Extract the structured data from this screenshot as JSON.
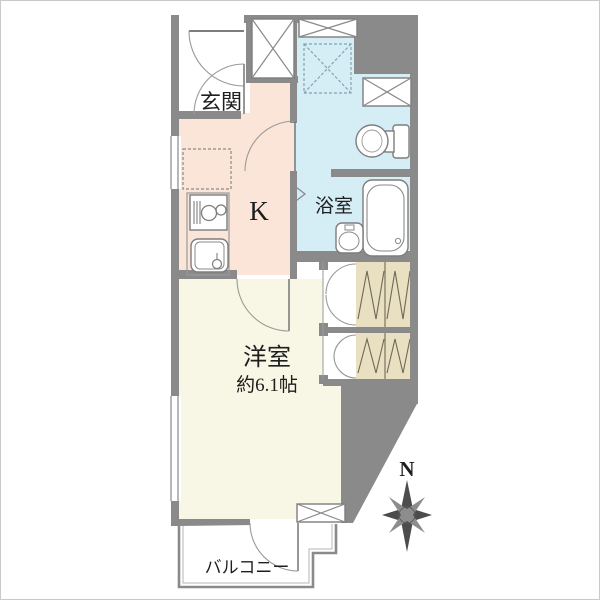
{
  "plan": {
    "rooms": {
      "genkan": {
        "label": "玄関"
      },
      "kitchen": {
        "label": "K"
      },
      "bathroom": {
        "label": "浴室"
      },
      "western_room": {
        "label": "洋室",
        "area": "約6.1帖"
      },
      "balcony": {
        "label": "バルコニー"
      }
    },
    "compass": {
      "north_label": "N"
    },
    "colors": {
      "wall_gray": "#8a8a8a",
      "wet_area_floor": "#d5eef6",
      "kitchen_floor": "#fae5d8",
      "main_room_floor": "#f8f6e4",
      "closet_fill": "#e9dfc1",
      "background": "#ffffff"
    }
  }
}
